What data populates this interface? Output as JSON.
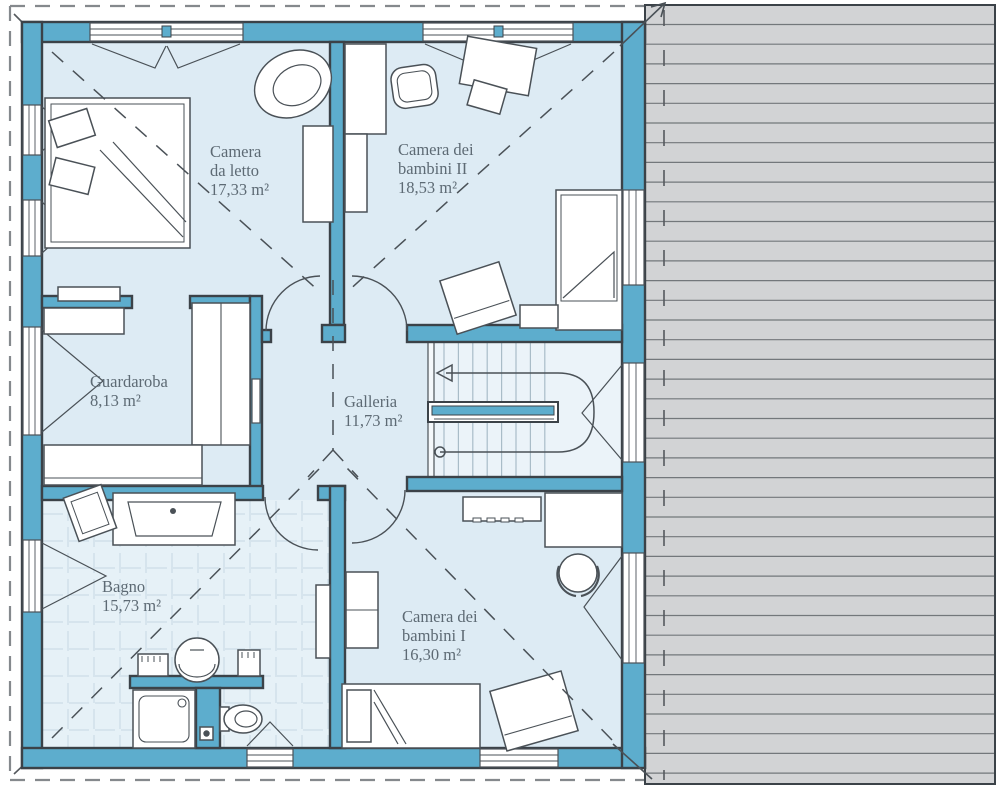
{
  "plan": {
    "language": "it",
    "rooms": [
      {
        "id": "camera-da-letto",
        "name_lines": [
          "Camera",
          "da letto"
        ],
        "area": "17,33 m²"
      },
      {
        "id": "camera-bambini-2",
        "name_lines": [
          "Camera dei",
          "bambini II"
        ],
        "area": "18,53 m²"
      },
      {
        "id": "guardaroba",
        "name_lines": [
          "Guardaroba"
        ],
        "area": "8,13 m²"
      },
      {
        "id": "galleria",
        "name_lines": [
          "Galleria"
        ],
        "area": "11,73 m²"
      },
      {
        "id": "bagno",
        "name_lines": [
          "Bagno"
        ],
        "area": "15,73 m²"
      },
      {
        "id": "camera-bambini-1",
        "name_lines": [
          "Camera dei",
          "bambini I"
        ],
        "area": "16,30 m²"
      }
    ],
    "palette": {
      "wall": "#5dadcd",
      "wall_outline": "#3b4248",
      "floor": "#ddebf4",
      "bath_floor": "#e6f1f7",
      "stair_floor": "#ebf3f9",
      "tile_line": "#c5d8e3",
      "tread_line": "#a9bcc8",
      "roof_fill": "#d2d3d5",
      "roof_line": "#73777b",
      "dash_line": "#4a5157",
      "text": "#5d6a74"
    }
  }
}
